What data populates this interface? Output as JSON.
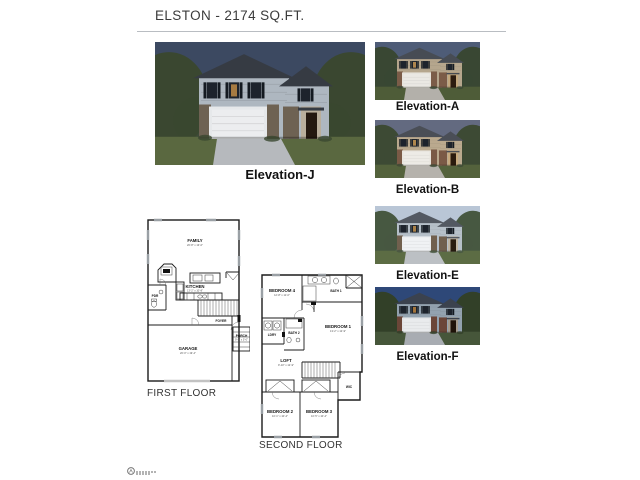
{
  "page": {
    "title": "ELSTON - 2174 SQ.FT."
  },
  "main_elevation": {
    "label": "Elevation-J",
    "style_vars": "--sky:#3c4961;--horizon:#7f8ca6;--trees:#3a4730;--lawn:#5a6840;--siding:#aeb7c0;--roof:#363b43;--base:#6e6253;--garage:#ecedef;--trim:#e6e8ea;--door:#241810;--glow:#d49a4a;--drive:#b6b9bd"
  },
  "elevations": [
    {
      "label": "Elevation-A",
      "style_vars": "--sky:#4e5c77;--horizon:#d2a06e;--trees:#394733;--lawn:#4e5c38;--siding:#b5a68d;--roof:#474c54;--base:#7b5c48;--garage:#eae8e3;--trim:#e6e3dc;--door:#2c1c10;--glow:#e0a85a;--drive:#b3b0aa"
    },
    {
      "label": "Elevation-B",
      "style_vars": "--sky:#636a80;--horizon:#e0b286;--trees:#3d4a34;--lawn:#54623c;--siding:#baa98e;--roof:#4a4e56;--base:#7a5a46;--garage:#edebe6;--trim:#e8e5de;--door:#2a1a0e;--glow:#e2aa58;--drive:#b5b2ac"
    },
    {
      "label": "Elevation-E",
      "style_vars": "--sky:#b9c6d6;--horizon:#dde5ee;--trees:#475841;--lawn:#5c6c44;--siding:#b6c0c9;--roof:#535962;--base:#71604e;--garage:#f0f2f4;--trim:#eceef0;--door:#281c10;--glow:#d8a050;--drive:#bcc0c4"
    },
    {
      "label": "Elevation-F",
      "style_vars": "--sky:#2e4878;--horizon:#7e92b8;--trees:#324028;--lawn:#46563a;--siding:#93a2af;--roof:#3b424e;--base:#6b4638;--garage:#e9ebed;--trim:#e2e4e6;--door:#201409;--glow:#d09040;--drive:#a8acb2"
    }
  ],
  "first_floor": {
    "label": "FIRST FLOOR",
    "rooms": {
      "family": {
        "name": "FAMILY",
        "dims": "20'-8\" x 13'-0\""
      },
      "kitchen": {
        "name": "KITCHEN",
        "dims": "13'-2\" x 10'-8\""
      },
      "pdr": {
        "name": "PDR"
      },
      "foyer": {
        "name": "FOYER"
      },
      "porch": {
        "name": "PORCH",
        "dims": "9'-8\" x 5'-0\""
      },
      "garage": {
        "name": "GARAGE",
        "dims": "20'-0\" x 19'-4\""
      }
    }
  },
  "second_floor": {
    "label": "SECOND FLOOR",
    "rooms": {
      "bedroom4": {
        "name": "BEDROOM 4",
        "dims": "12'-8\" x 11'-0\""
      },
      "bath1": {
        "name": "BATH 1"
      },
      "ldry": {
        "name": "LDRY"
      },
      "bath2": {
        "name": "BATH 2"
      },
      "bedroom1": {
        "name": "BEDROOM 1",
        "dims": "13'-2\" x 12'-9\""
      },
      "loft": {
        "name": "LOFT",
        "dims": "9'-10\" x 12'-9\""
      },
      "wic": {
        "name": "WIC"
      },
      "bedroom2": {
        "name": "BEDROOM 2",
        "dims": "10'-1\" x 10'-4\""
      },
      "bedroom3": {
        "name": "BEDROOM 3",
        "dims": "10'-5\" x 10'-4\""
      }
    }
  }
}
